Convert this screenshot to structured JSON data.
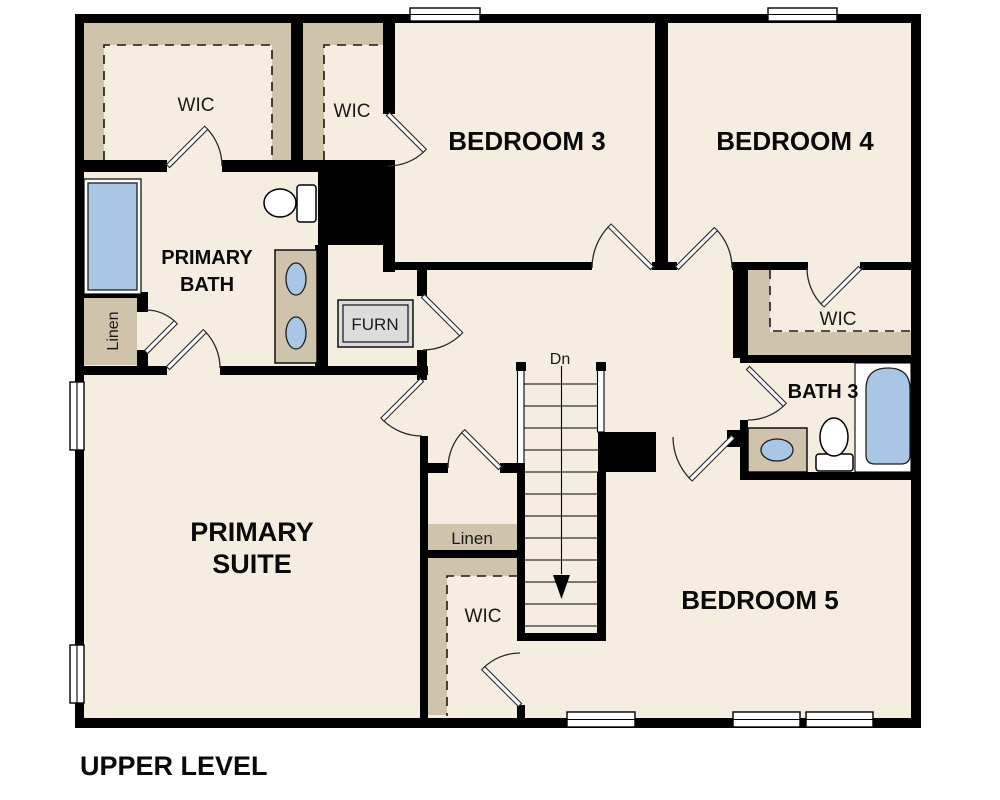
{
  "plan": {
    "title": "UPPER LEVEL",
    "stairs_label": "Dn",
    "rooms": {
      "primary_wic": "WIC",
      "bedroom3_wic": "WIC",
      "bedroom3": "BEDROOM 3",
      "bedroom4": "BEDROOM 4",
      "primary_bath_line1": "PRIMARY",
      "primary_bath_line2": "BATH",
      "linen_left": "Linen",
      "furnace": "FURN",
      "bedroom4_wic": "WIC",
      "bath3": "BATH 3",
      "primary_suite_line1": "PRIMARY",
      "primary_suite_line2": "SUITE",
      "linen_hall": "Linen",
      "bedroom5_wic": "WIC",
      "bedroom5": "BEDROOM 5"
    },
    "colors": {
      "floor": "#f5ede0",
      "band": "#cfc3ac",
      "blue": "#a9c7e4",
      "wall": "#000000",
      "furn": "#dcdcdc"
    }
  }
}
